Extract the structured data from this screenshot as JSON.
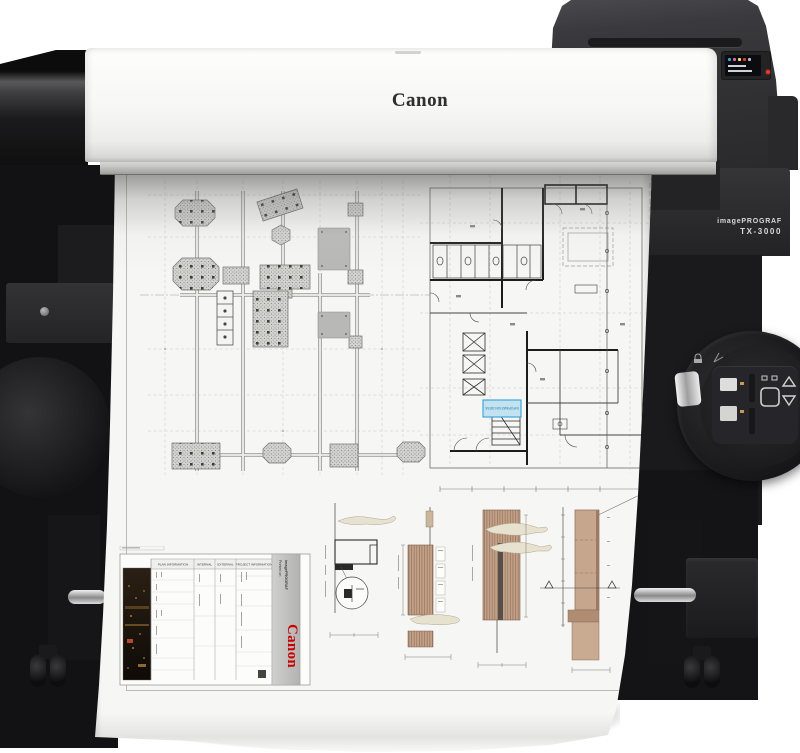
{
  "printer": {
    "brand_logo": "Canon",
    "side_label": {
      "line1": "imagePROGRAF",
      "line2": "TX-3000"
    },
    "control_screen": {
      "ink_colors": [
        "#29abe2",
        "#ec5fa8",
        "#f7e94a",
        "#e8392e"
      ],
      "power_led_color": "#e8392e"
    }
  },
  "printout": {
    "highlight_box": {
      "label": "INFORMATION DESK",
      "border_color": "#2fa3d6",
      "fill_color": "#c3e2f0"
    },
    "title_block": {
      "headers": [
        "PLAN INFORMATION",
        "INTERNAL",
        "EXTERNAL",
        "PROJECT INFORMATION"
      ],
      "printed_on_line1": "Printed on",
      "printed_on_line2": "imagePROGRAF",
      "brand": "Canon",
      "brand_color": "#cc0000"
    },
    "drawing_colors": {
      "accent_tan": "#c2a188",
      "accent_cyan": "#2fa3d6"
    }
  }
}
